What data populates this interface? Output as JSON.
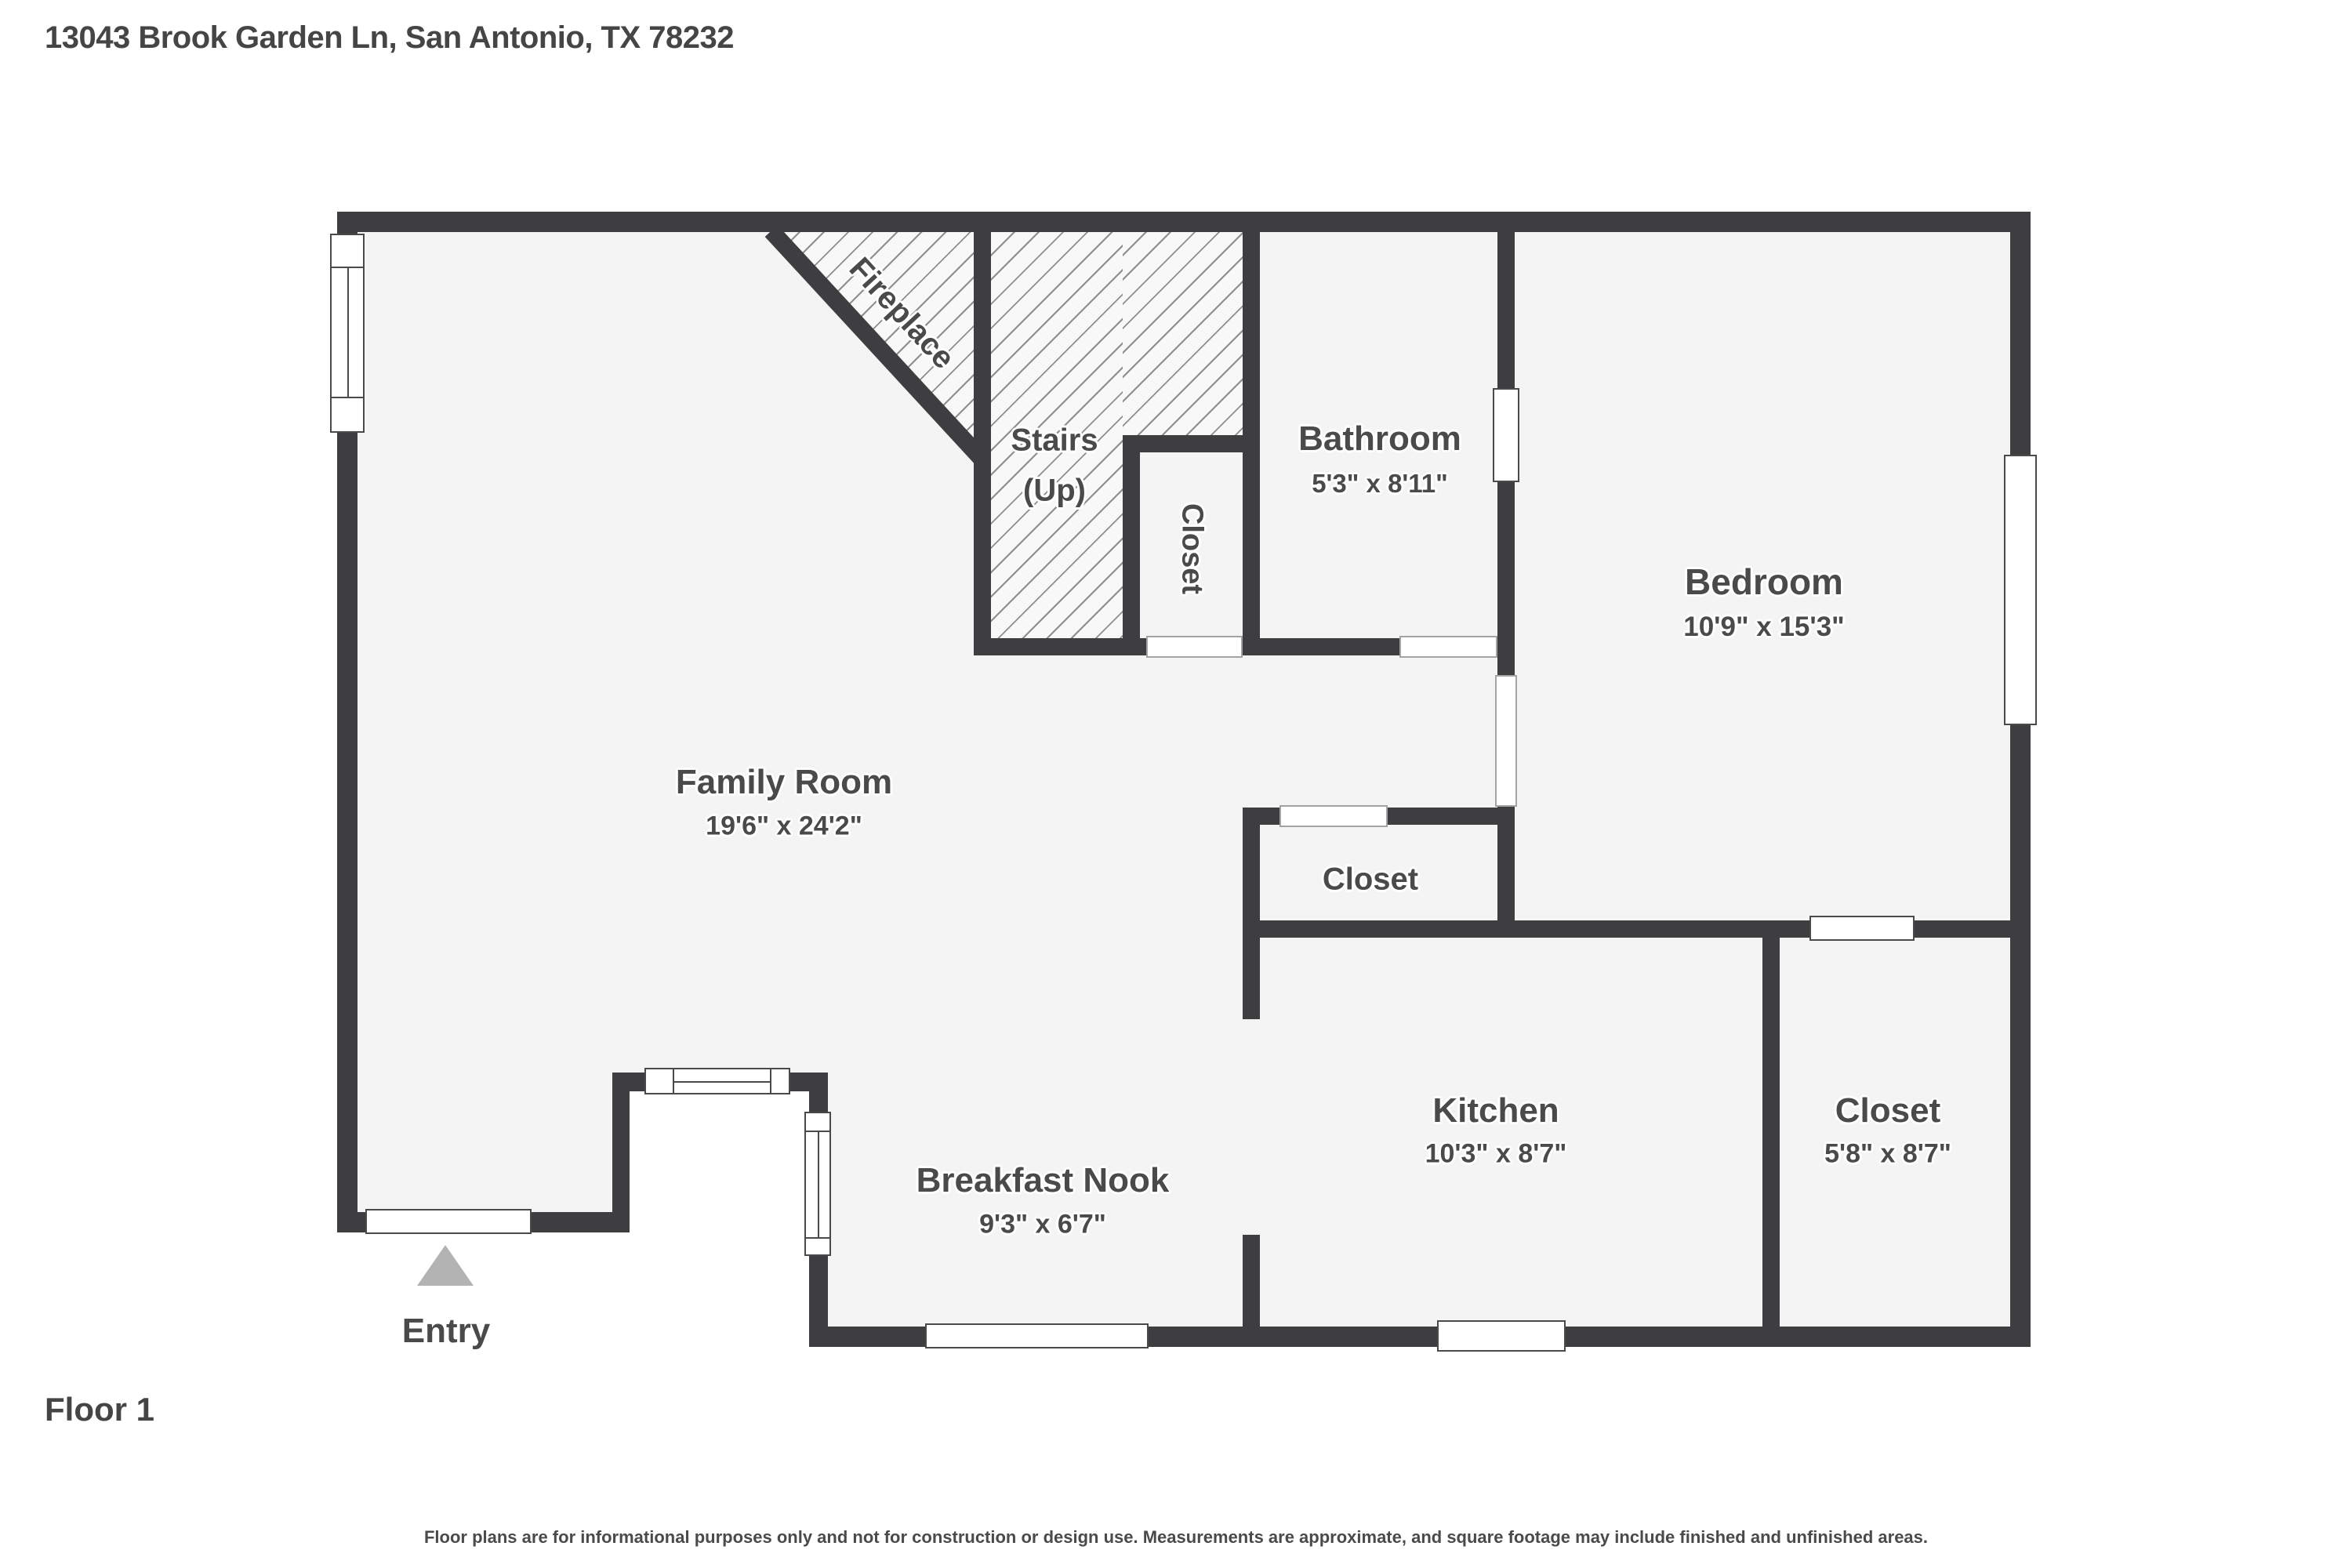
{
  "header": {
    "address": "13043 Brook Garden Ln, San Antonio, TX 78232"
  },
  "footer": {
    "floor_label": "Floor 1",
    "disclaimer": "Floor plans are for informational purposes only and not for construction or design use. Measurements are approximate, and square footage may include finished and unfinished areas."
  },
  "colors": {
    "wall": "#3e3e40",
    "floor": "#f4f4f5",
    "hatch_line": "#8e8e8e",
    "label_text": "#4a4a4a",
    "entry_arrow": "#b3b3b3",
    "window_outline": "#4a4a4a"
  },
  "rooms": {
    "family_room": {
      "name": "Family Room",
      "dims": "19'6\" x 24'2\""
    },
    "fireplace": {
      "name": "Fireplace"
    },
    "stairs": {
      "name": "Stairs",
      "sub": "(Up)"
    },
    "closet_stairs": {
      "name": "Closet"
    },
    "bathroom": {
      "name": "Bathroom",
      "dims": "5'3\" x 8'11\""
    },
    "bedroom": {
      "name": "Bedroom",
      "dims": "10'9\" x 15'3\""
    },
    "closet_hall": {
      "name": "Closet"
    },
    "kitchen": {
      "name": "Kitchen",
      "dims": "10'3\" x 8'7\""
    },
    "closet_right": {
      "name": "Closet",
      "dims": "5'8\" x 8'7\""
    },
    "breakfast_nook": {
      "name": "Breakfast Nook",
      "dims": "9'3\" x 6'7\""
    },
    "entry": {
      "name": "Entry"
    }
  }
}
